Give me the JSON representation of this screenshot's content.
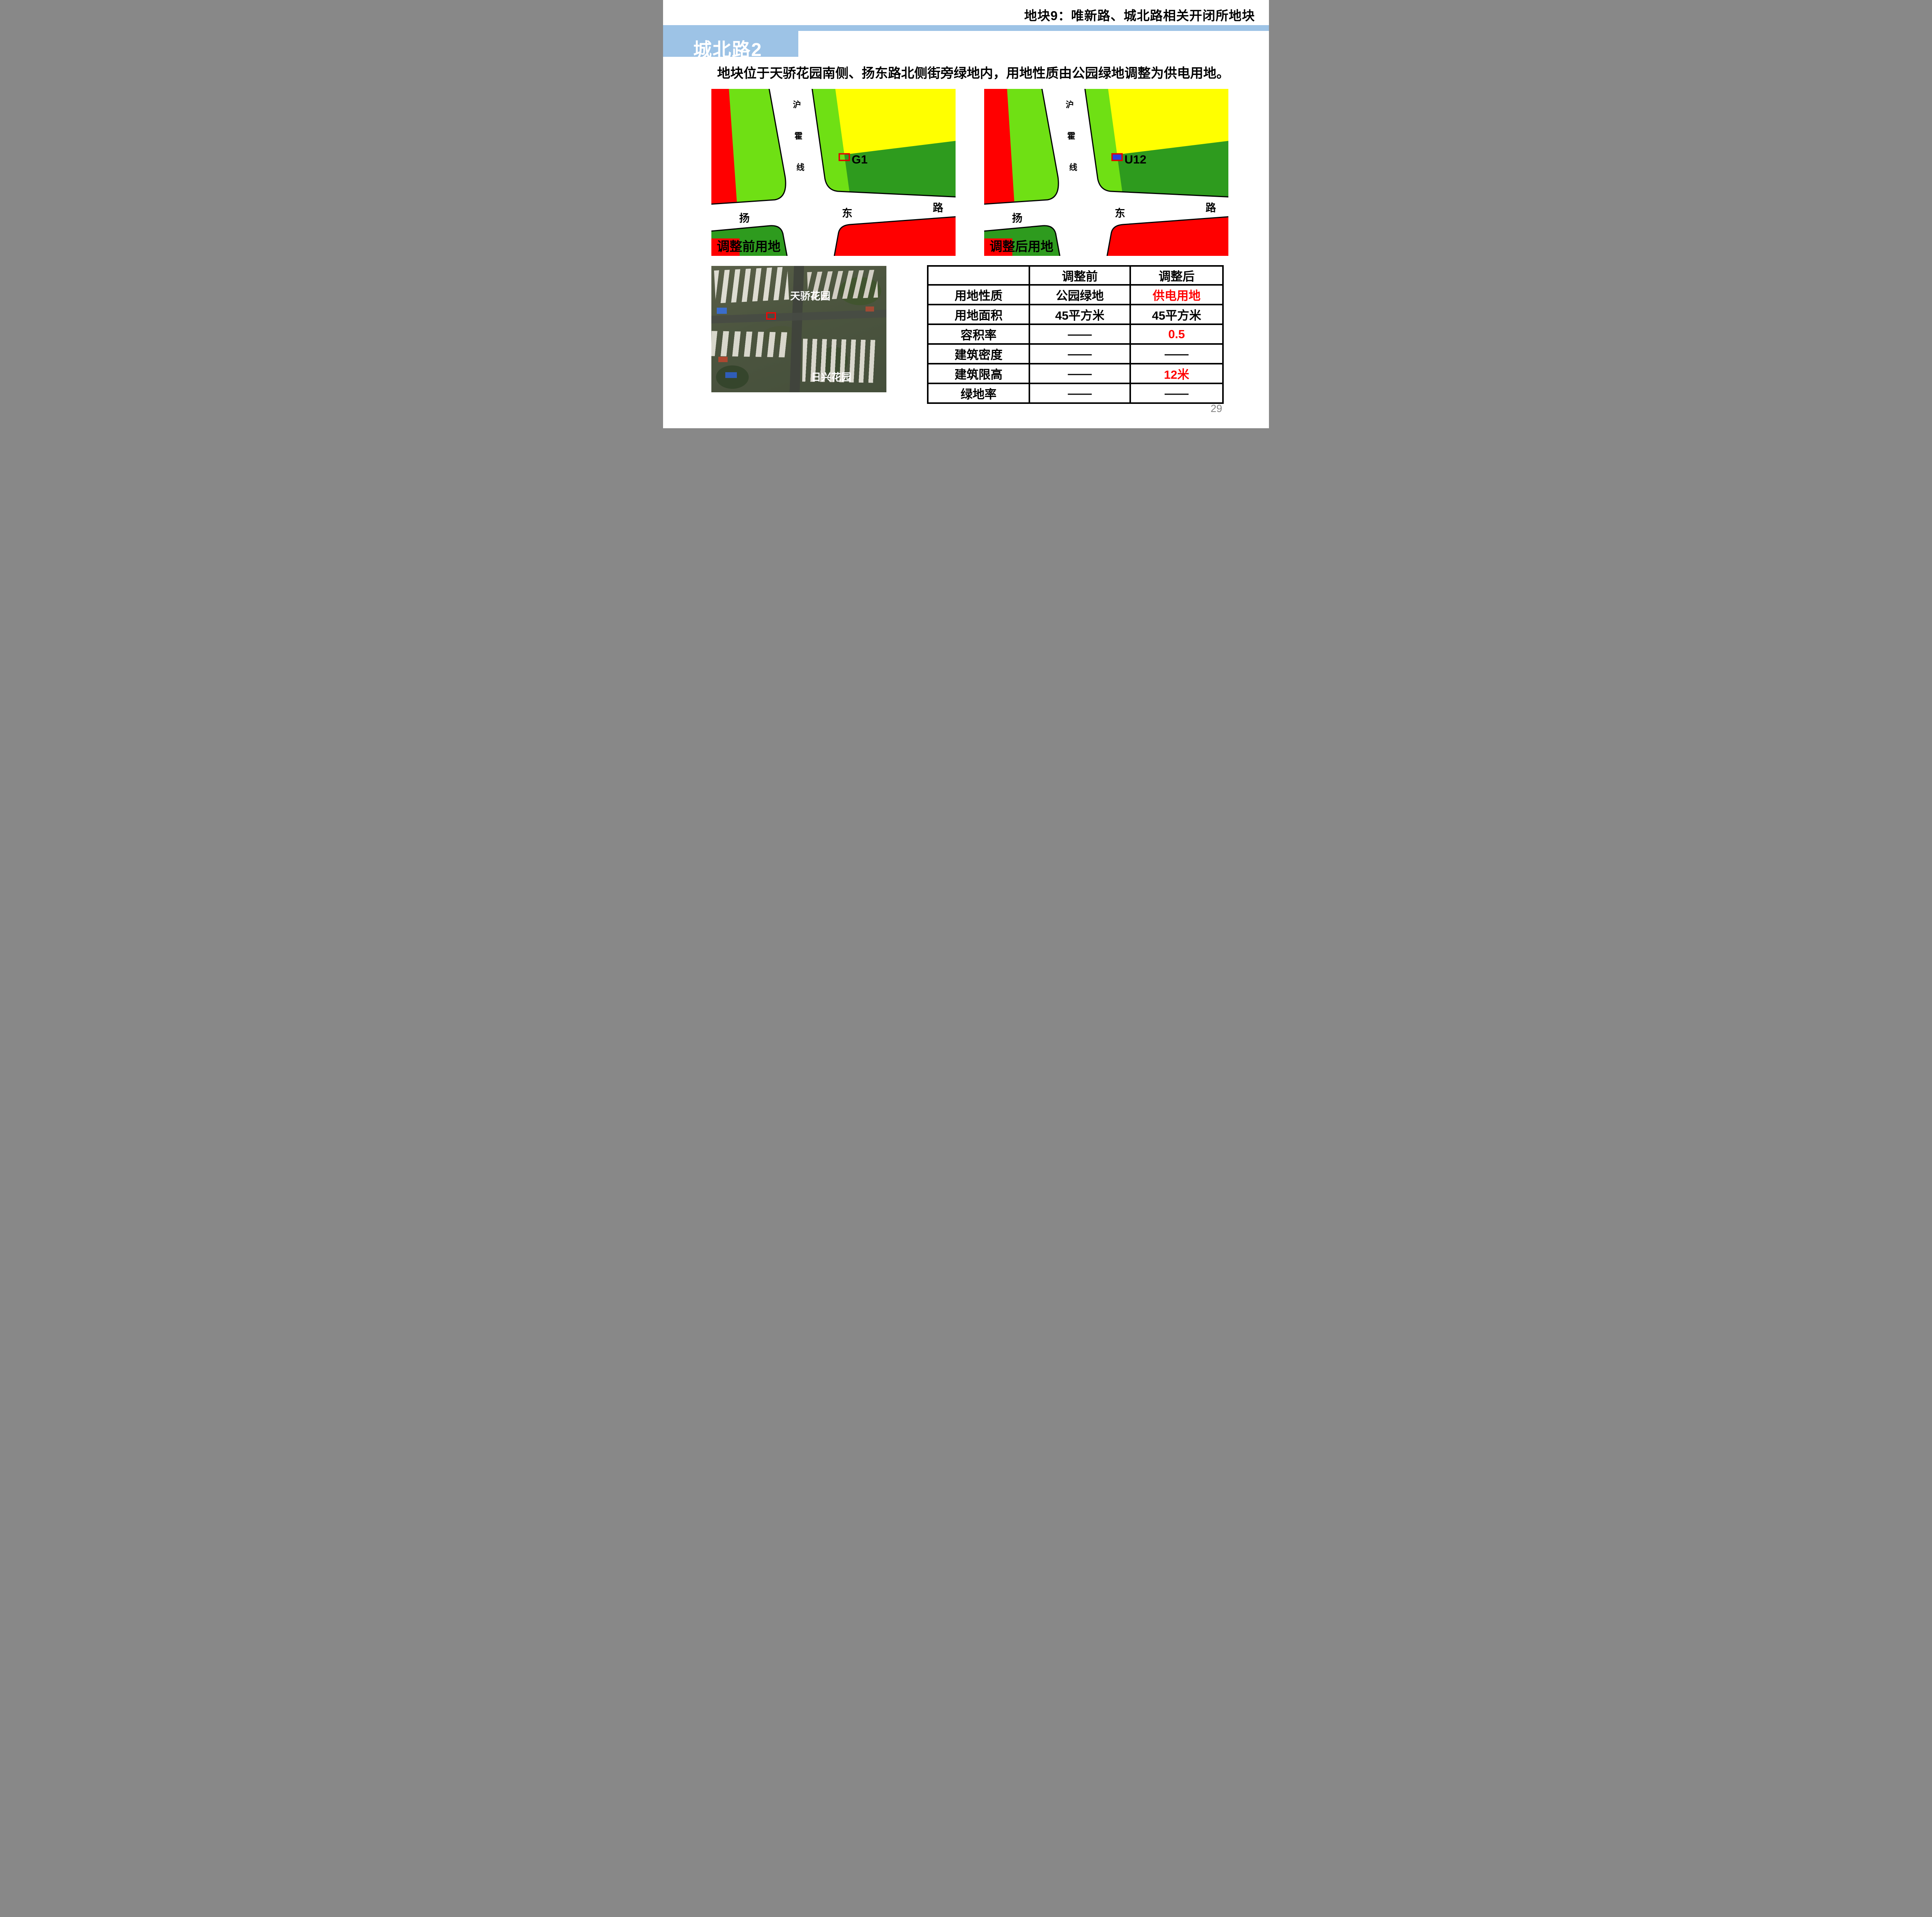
{
  "header": {
    "slide_title": "地块9：唯新路、城北路相关开闭所地块",
    "section_label": "城北路2"
  },
  "description": "地块位于天骄花园南侧、扬东路北侧街旁绿地内，用地性质由公园绿地调整为供电用地。",
  "maps": {
    "road_vertical": [
      "沪",
      "霍",
      "线"
    ],
    "road_horizontal": [
      "扬",
      "东",
      "路"
    ],
    "before": {
      "caption": "调整前用地",
      "marker_label": "G1"
    },
    "after": {
      "caption": "调整后用地",
      "marker_label": "U12"
    }
  },
  "aerial": {
    "label_top": "天骄花园",
    "label_bottom": "日兴花园"
  },
  "table": {
    "col_before": "调整前",
    "col_after": "调整后",
    "rows": [
      {
        "label": "用地性质",
        "before": "公园绿地",
        "after": "供电用地"
      },
      {
        "label": "用地面积",
        "before": "45平方米",
        "after": "45平方米"
      },
      {
        "label": "容积率",
        "before": "——",
        "after": "0.5"
      },
      {
        "label": "建筑密度",
        "before": "——",
        "after": "——"
      },
      {
        "label": "建筑限高",
        "before": "——",
        "after": "12米"
      },
      {
        "label": "绿地率",
        "before": "——",
        "after": "——"
      }
    ]
  },
  "page_number": "29",
  "colors": {
    "banner_blue": "#9DC3E6",
    "light_green": "#6FE014",
    "dark_green": "#2E9B1E",
    "yellow": "#FFFF00",
    "parcel_red": "#FF0000",
    "marker_outline_red": "#E60000",
    "marker_fill_blue": "#2840E0",
    "highlight_text_red": "#FF0000"
  }
}
